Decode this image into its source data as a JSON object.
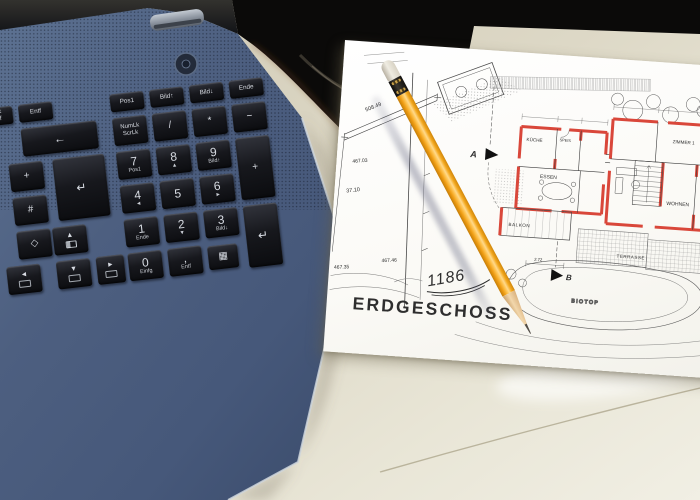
{
  "keyboard": {
    "druck_main": "Druck",
    "druck_sub": "S-Abf",
    "entf_key": "Entf",
    "pos1_key": "Pos1",
    "bild_up_key": "Bild↑",
    "bild_down_key": "Bild↓",
    "ende_key": "Ende",
    "backspace_glyph": "←",
    "numlk_main": "NumLk",
    "numlk_sub": "ScrLk",
    "divide_key": "/",
    "multiply_key": "*",
    "minus_key": "−",
    "plus_left_key": "+",
    "hash_key": "#",
    "enter_glyph": "↵",
    "diamond_glyph": "◇",
    "num7": "7",
    "num7_sub": "Pos1",
    "num8": "8",
    "num8_sub": "▲",
    "num9": "9",
    "num9_sub": "Bild↑",
    "num4": "4",
    "num4_sub": "◄",
    "num5": "5",
    "num6": "6",
    "num6_sub": "►",
    "num1": "1",
    "num1_sub": "Ende",
    "num2": "2",
    "num2_sub": "▼",
    "num3": "3",
    "num3_sub": "Bild↓",
    "num0": "0",
    "num0_sub": "Einfg",
    "comma_key": ",",
    "comma_sub": "Entf",
    "numpad_plus": "+",
    "numpad_enter_glyph": "↵",
    "calc_glyph": "▦",
    "arrow_up": "▲",
    "arrow_left": "◄",
    "arrow_down": "▼",
    "arrow_right": "►"
  },
  "plan": {
    "title": "ERDGESCHOSS",
    "handwritten_number": "1186",
    "room_kueche": "KÜCHE",
    "room_speis": "SPEIS",
    "room_essen": "ESSEN",
    "room_balkon": "BALKON",
    "room_wohnen": "WOHNEN",
    "room_zimmer1": "ZIMMER 1",
    "area_terrasse": "TERRASSE",
    "area_biotop": "BIOTOP",
    "elev_508_49": "508.49",
    "elev_467_03": "467.03",
    "elev_467_35": "467.35",
    "elev_467_46": "467.46",
    "dim_37_10": "37.10",
    "dim_2_72": "2.72",
    "dim_1_85": "1.85",
    "section_a": "A",
    "section_b": "B"
  }
}
